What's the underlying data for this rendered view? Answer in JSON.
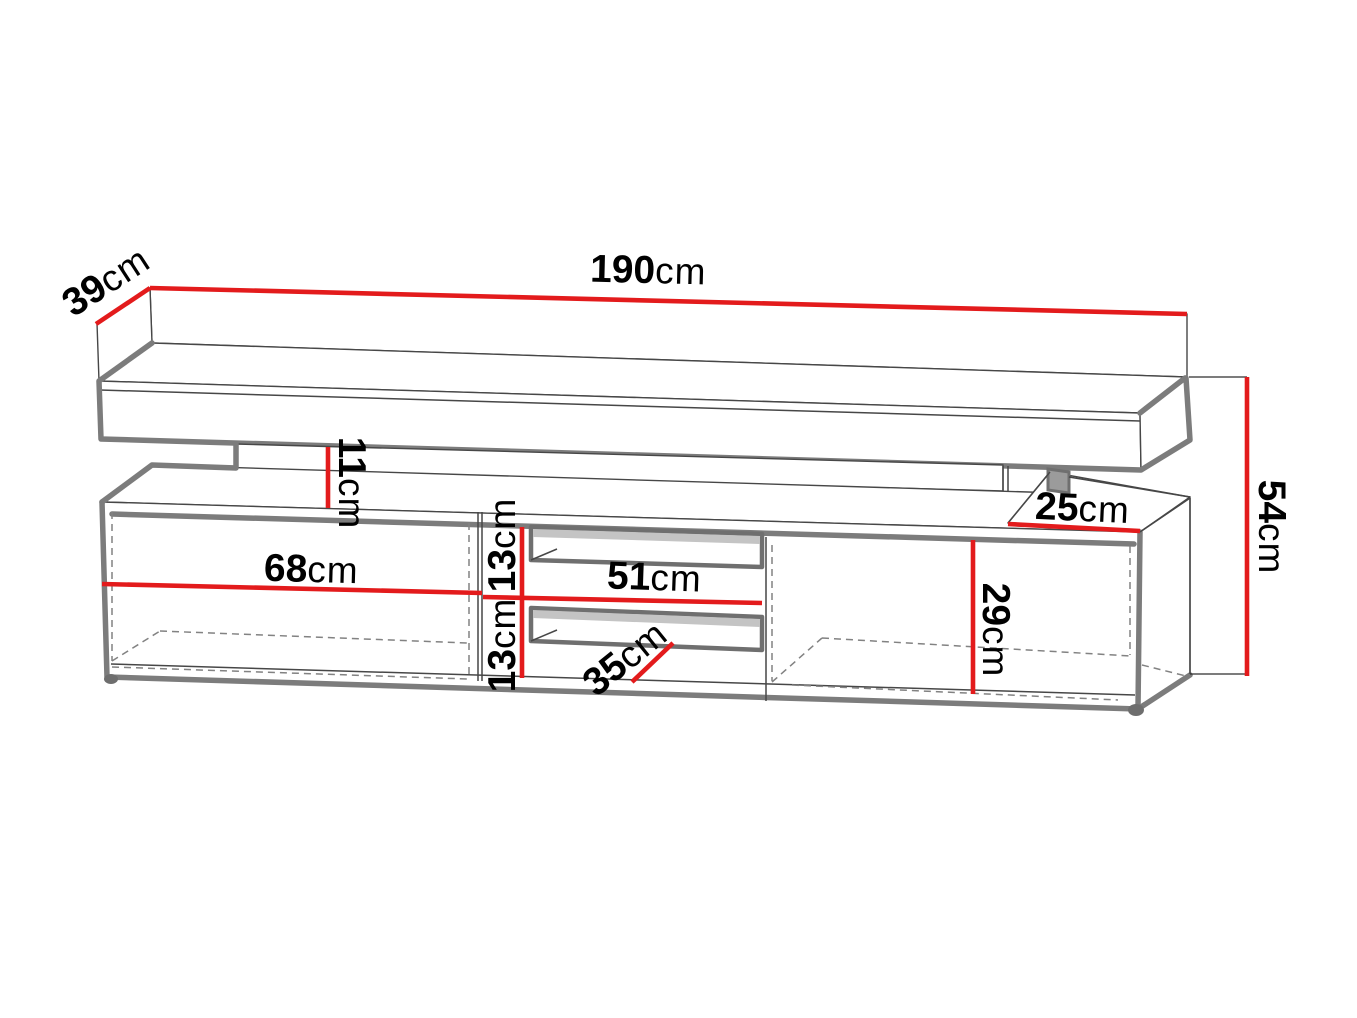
{
  "diagram": {
    "kind": "furniture-dimension-drawing",
    "subject": "TV stand with top shelf, two open side compartments and two middle niches"
  },
  "colors": {
    "dimension_line": "#e31b1c",
    "outline_thick": "#7c7c7c",
    "outline_thin": "#474747",
    "label_text": "#000000",
    "background": "#ffffff"
  },
  "dimensions": {
    "total_width": {
      "value": "190",
      "unit": "cm"
    },
    "top_depth": {
      "value": "39",
      "unit": "cm"
    },
    "total_height": {
      "value": "54",
      "unit": "cm"
    },
    "shelf_gap": {
      "value": "11",
      "unit": "cm"
    },
    "right_top_depth": {
      "value": "25",
      "unit": "cm"
    },
    "left_compartment": {
      "value": "68",
      "unit": "cm"
    },
    "niche_width": {
      "value": "51",
      "unit": "cm"
    },
    "upper_niche_height": {
      "value": "13",
      "unit": "cm"
    },
    "lower_niche_height": {
      "value": "13",
      "unit": "cm"
    },
    "niche_depth": {
      "value": "35",
      "unit": "cm"
    },
    "right_compartment": {
      "value": "29",
      "unit": "cm"
    }
  }
}
